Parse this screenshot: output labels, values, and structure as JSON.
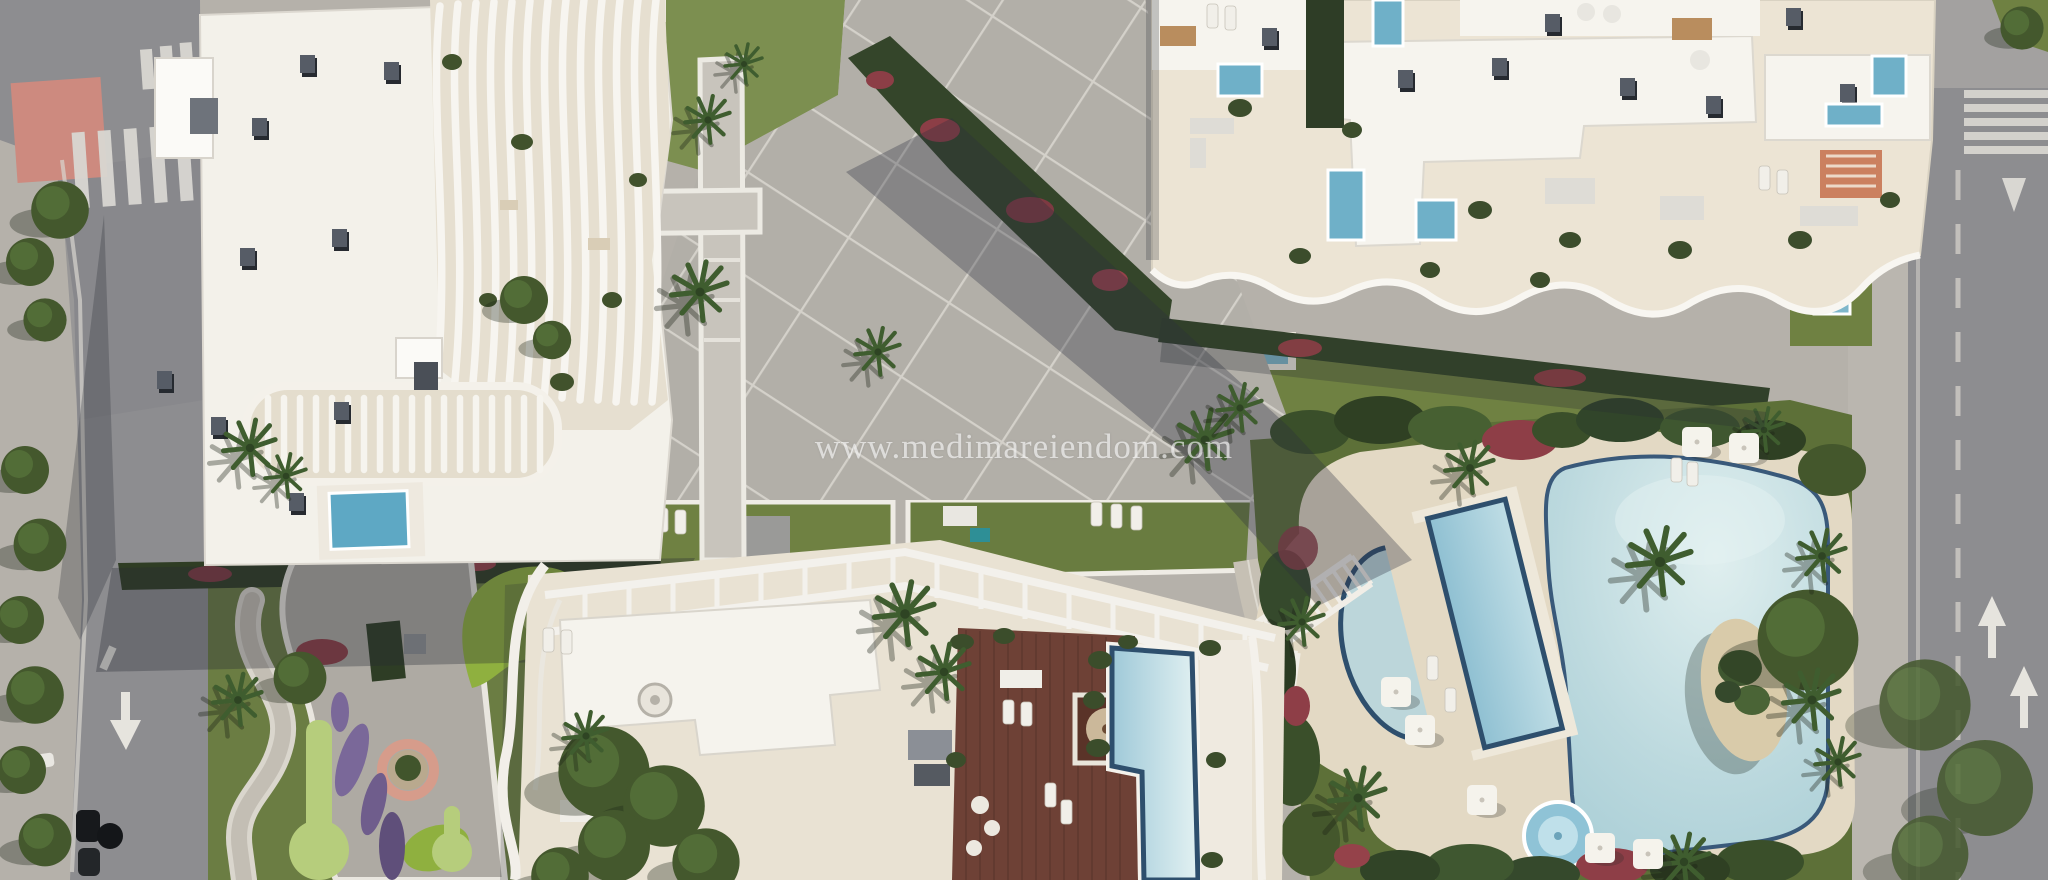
{
  "scene": {
    "type": "aerial-architectural-render",
    "subject": "Top-down 3D render of a Mediterranean residential resort complex with three apartment buildings, rooftop terraces, plunge pools, gardens and a lagoon pool area between two roads",
    "watermark": {
      "text": "www.medimareiendom.com"
    },
    "palette": {
      "asphalt": "#8d8d90",
      "pavement": "#b5b1aa",
      "sidewalk": "#c6c2ba",
      "building_white": "#f4f2ec",
      "terrace_beige": "#ece4d4",
      "deck_sand": "#e3d9c4",
      "wood_deck": "#6e4136",
      "lawn_green": "#6f8142",
      "golf_green": "#8fb03f",
      "hedge_dark": "#31402a",
      "tree_green": "#47602f",
      "flower_red": "#8e3e47",
      "flower_purple": "#7a6899",
      "pool_blue": "#a9d0da",
      "pool_rim": "#2e4f6d",
      "sand_island": "#d9cbaa",
      "bike_lane_pink": "#cd8a7f",
      "road_marking": "#d9d7d2",
      "cast_shadow": "rgba(42,48,62,0.33)"
    },
    "regions": [
      {
        "name": "left-road",
        "label": "Road with crosswalk, pink painted corner, lane arrow and parked cars"
      },
      {
        "name": "right-road",
        "label": "Road with crosswalk, yield triangle, dashed lane line and lane arrows"
      },
      {
        "name": "building-top-left",
        "label": "White apartment building with wavy balcony slats and rooftop vents"
      },
      {
        "name": "building-top-right",
        "label": "White apartment building with beige roof terraces, plunge pools and scalloped balcony edge"
      },
      {
        "name": "building-bottom",
        "label": "Apartment building with pergolas, wooden penthouse deck and rooftop pool"
      },
      {
        "name": "central-plaza",
        "label": "Diagonal paved plaza with white grid lines, lawns and palm trees"
      },
      {
        "name": "pool-complex",
        "label": "Lagoon pool with sand island, lap pool, half-moon pool and round jacuzzi in lush garden"
      },
      {
        "name": "playground-garden",
        "label": "Garden with winding paths, mini-golf greens, play circle and flower beds"
      }
    ]
  }
}
